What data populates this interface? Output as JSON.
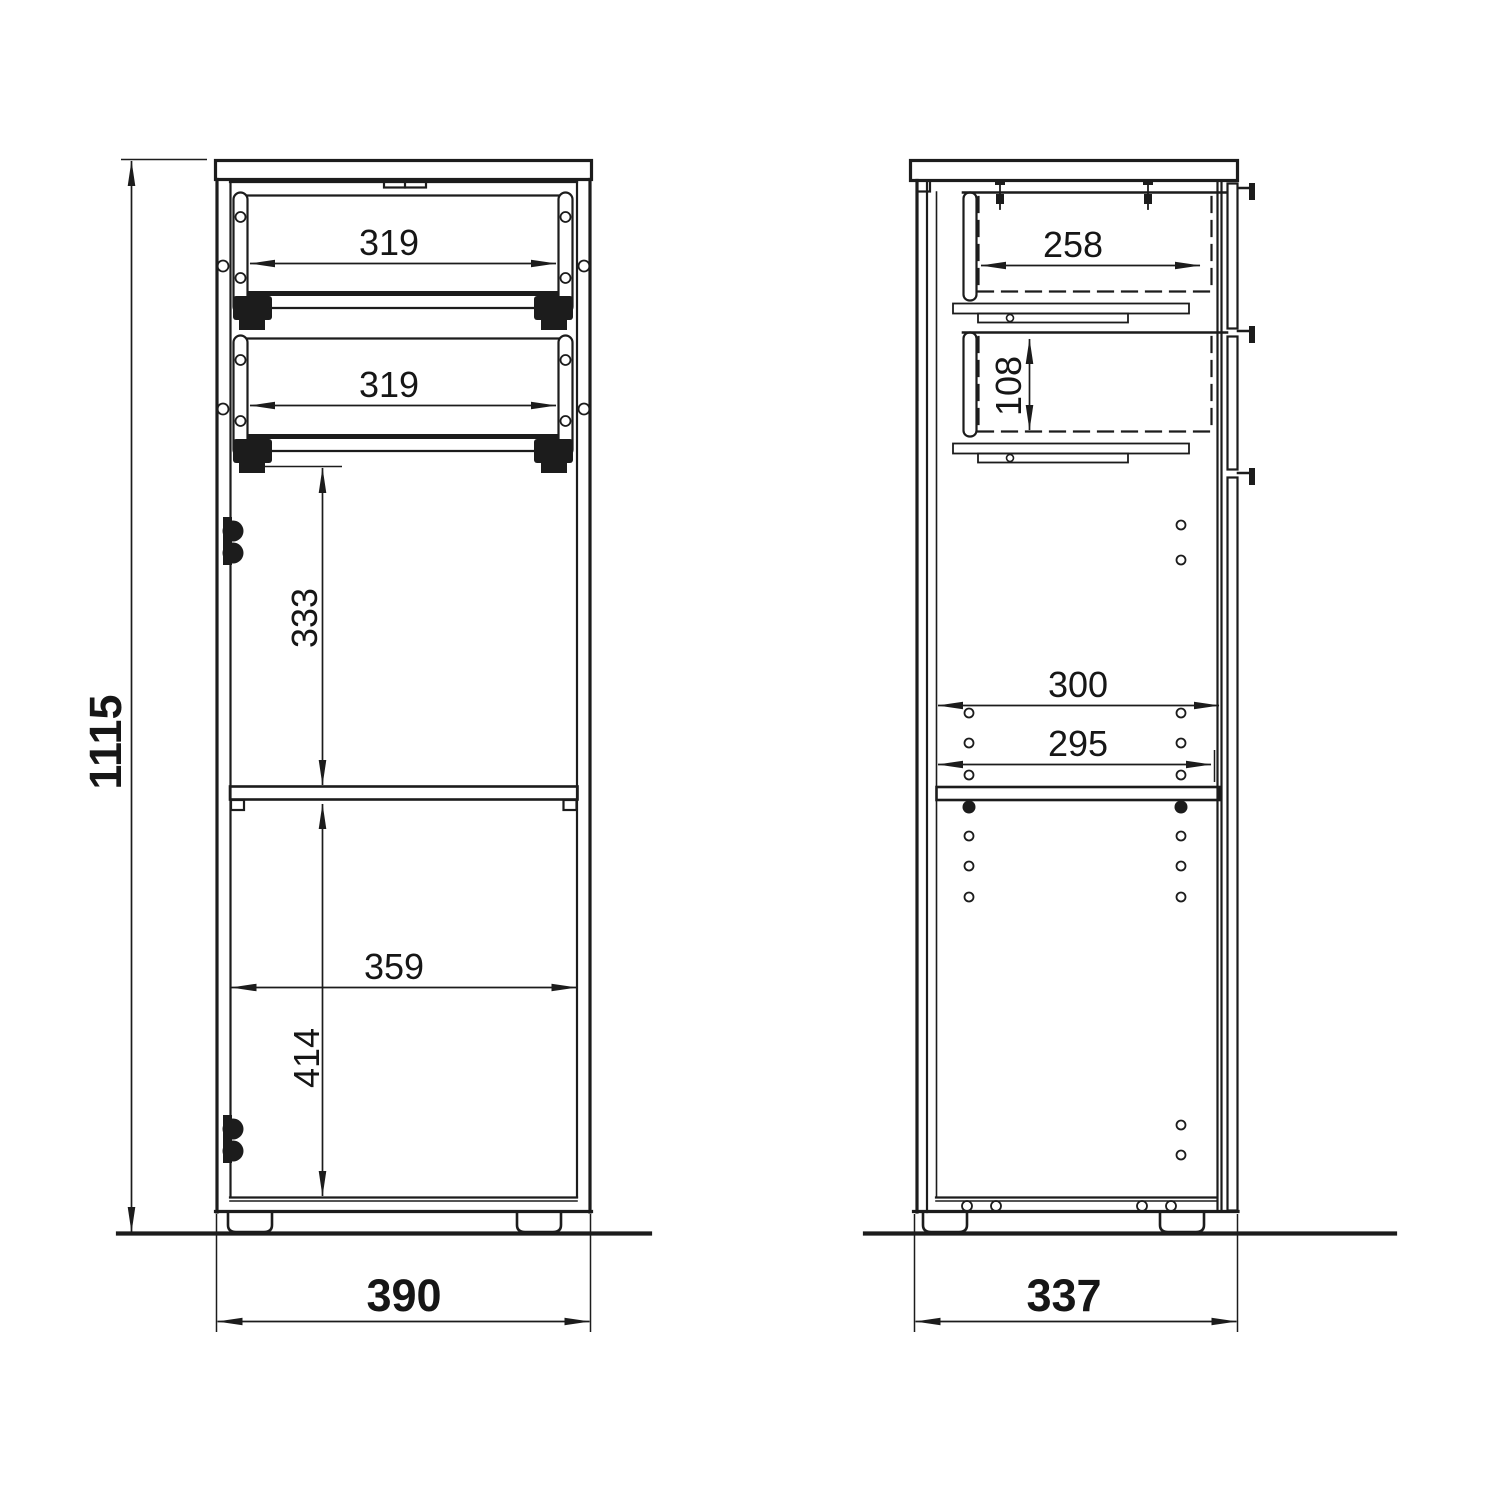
{
  "title": "cabinet-technical-drawing",
  "colors": {
    "line": "#1c1c1c",
    "background": "#ffffff"
  },
  "front_view": {
    "dimensions": {
      "drawer1_inner_width": "319",
      "drawer2_inner_width": "319",
      "upper_compartment_height": "333",
      "interior_width": "359",
      "lower_compartment_height": "414",
      "overall_height": "1115",
      "overall_width": "390"
    }
  },
  "side_view": {
    "dimensions": {
      "drawer_inner_depth": "258",
      "drawer_inner_height": "108",
      "interior_depth_top": "300",
      "interior_depth_shelf": "295",
      "overall_depth": "337"
    }
  }
}
